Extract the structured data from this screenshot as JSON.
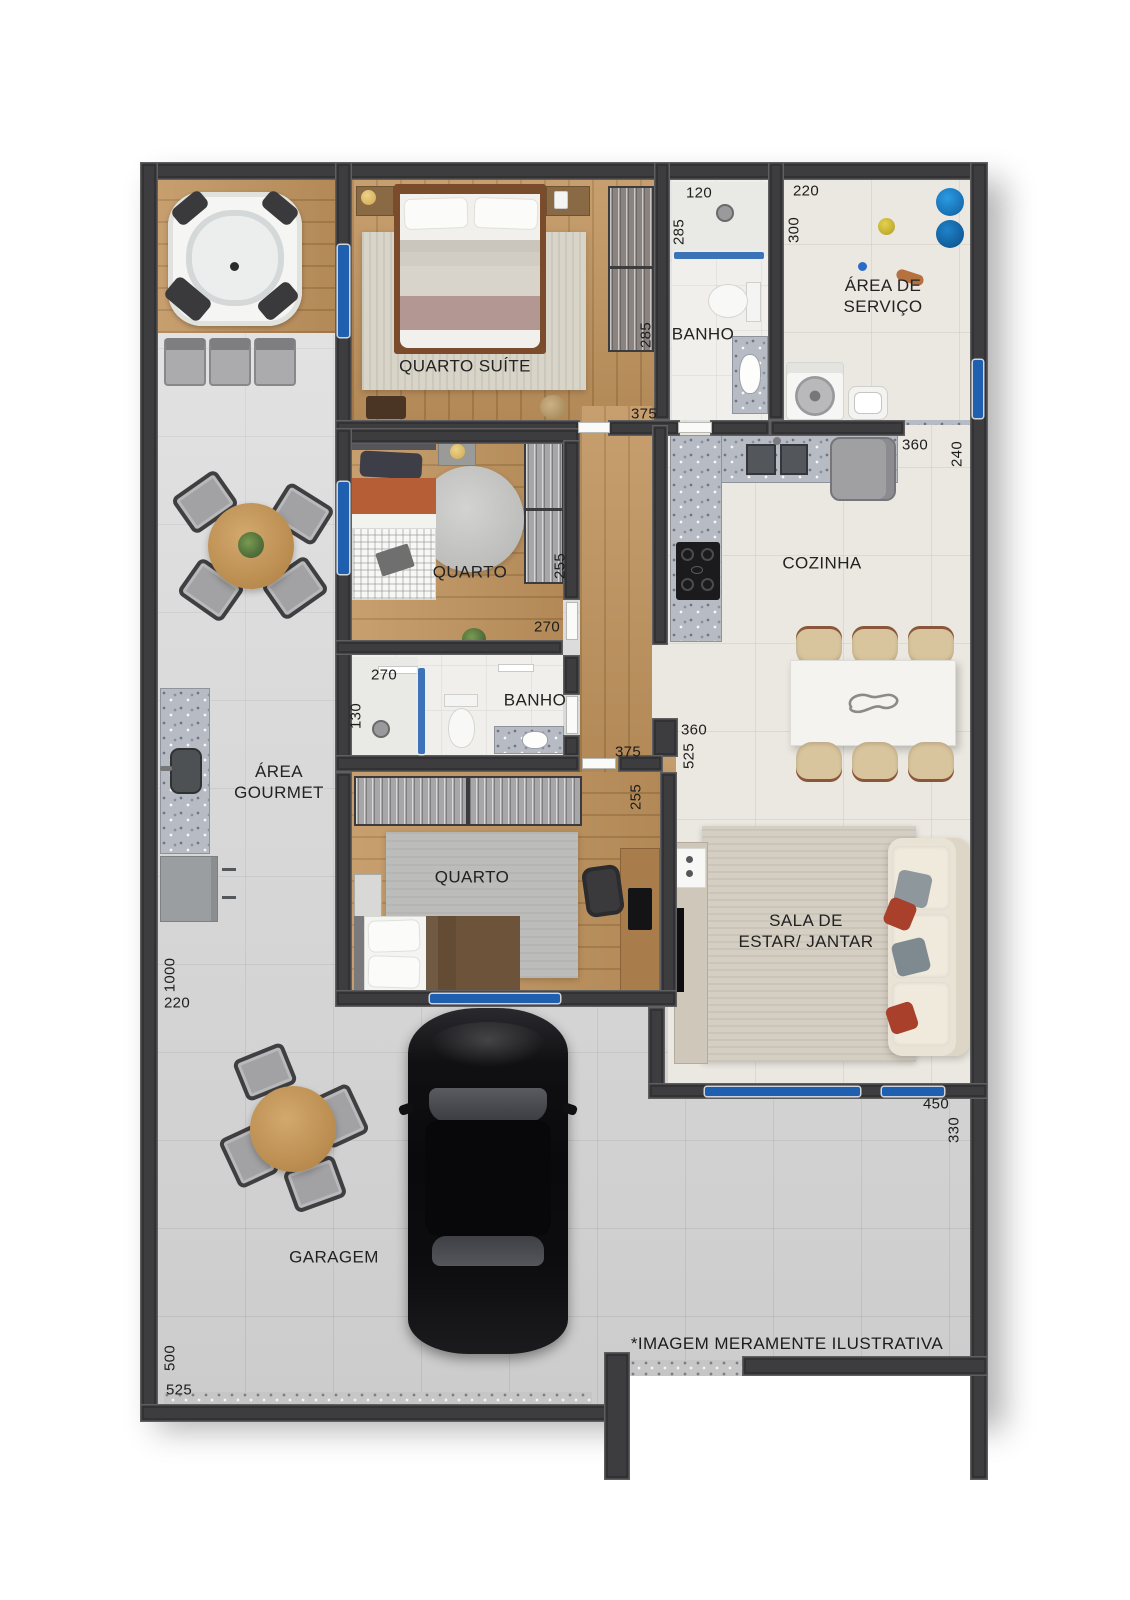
{
  "palette": {
    "wall": "#3d3d40",
    "window": "#1e5fb0",
    "wood_floor": "#c1945e",
    "tile_gray": "#d7d7d7",
    "tile_cream": "#ebe8e1",
    "granite": "#b6bbc4",
    "bucket_blue": "#1479c4",
    "car_black": "#121214"
  },
  "rooms": {
    "suite": {
      "label": "QUARTO SUÍTE"
    },
    "banho1": {
      "label": "BANHO"
    },
    "servico": {
      "lines": [
        "ÁREA DE",
        "SERVIÇO"
      ]
    },
    "cozinha": {
      "label": "COZINHA"
    },
    "quarto2": {
      "label": "QUARTO"
    },
    "banho2": {
      "label": "BANHO"
    },
    "gourmet": {
      "lines": [
        "ÁREA",
        "GOURMET"
      ]
    },
    "quarto3": {
      "label": "QUARTO"
    },
    "sala": {
      "lines": [
        "SALA DE",
        "ESTAR/ JANTAR"
      ]
    },
    "garagem": {
      "label": "GARAGEM"
    }
  },
  "dims": {
    "banho1_width": "120",
    "servico_width": "220",
    "banho1_depth": "285",
    "servico_depth": "300",
    "suite_closet": "285",
    "hall_upper": "375",
    "cozinha_width": "360",
    "cozinha_depth": "240",
    "quarto2_closet": "255",
    "quarto2_width": "270",
    "banho2_width": "270",
    "banho2_depth": "130",
    "hall_lower": "375",
    "sala_opening": "360",
    "sala_depth": "525",
    "quarto3_side": "255",
    "gourmet_length": "1000",
    "gourmet_width": "220",
    "sala_width": "450",
    "sala_side": "330",
    "garagem_depth": "500",
    "garagem_width": "525"
  },
  "disclaimer": "*IMAGEM MERAMENTE ILUSTRATIVA"
}
